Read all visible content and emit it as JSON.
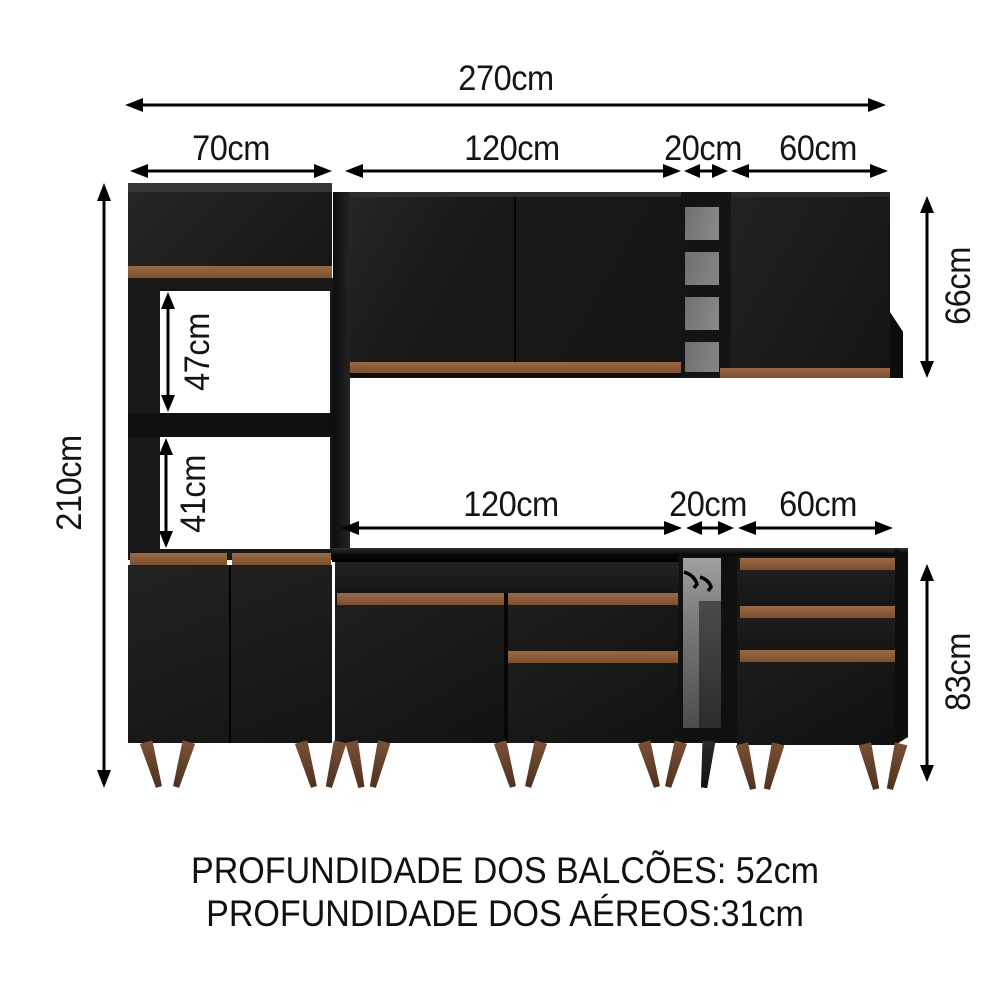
{
  "diagram": {
    "type": "furniture-dimension-diagram",
    "subject": "modular kitchen cabinet set (black with wood trim)",
    "labels": {
      "total_width": "270cm",
      "tower_width": "70cm",
      "upper_cabinet_width": "120cm",
      "upper_shelf_width": "20cm",
      "upper_right_cabinet_width": "60cm",
      "lower_cabinet_width": "120cm",
      "lower_shelf_width": "20cm",
      "lower_right_cabinet_width": "60cm",
      "total_height": "210cm",
      "upper_cabinet_height": "66cm",
      "niche_top_height": "47cm",
      "niche_bottom_height": "41cm",
      "base_cabinet_height": "83cm"
    },
    "notes": {
      "line1": "PROFUNDIDADE DOS BALCÕES: 52cm",
      "line2": "PROFUNDIDADE DOS AÉREOS:31cm"
    },
    "colors": {
      "background": "#ffffff",
      "cabinet_black": "#1c1c1c",
      "wood_trim": "#8a5a3a",
      "leg_wood": "#6f4832",
      "niche_back": "#7c7c7c",
      "dimension_lines": "#000000"
    }
  }
}
